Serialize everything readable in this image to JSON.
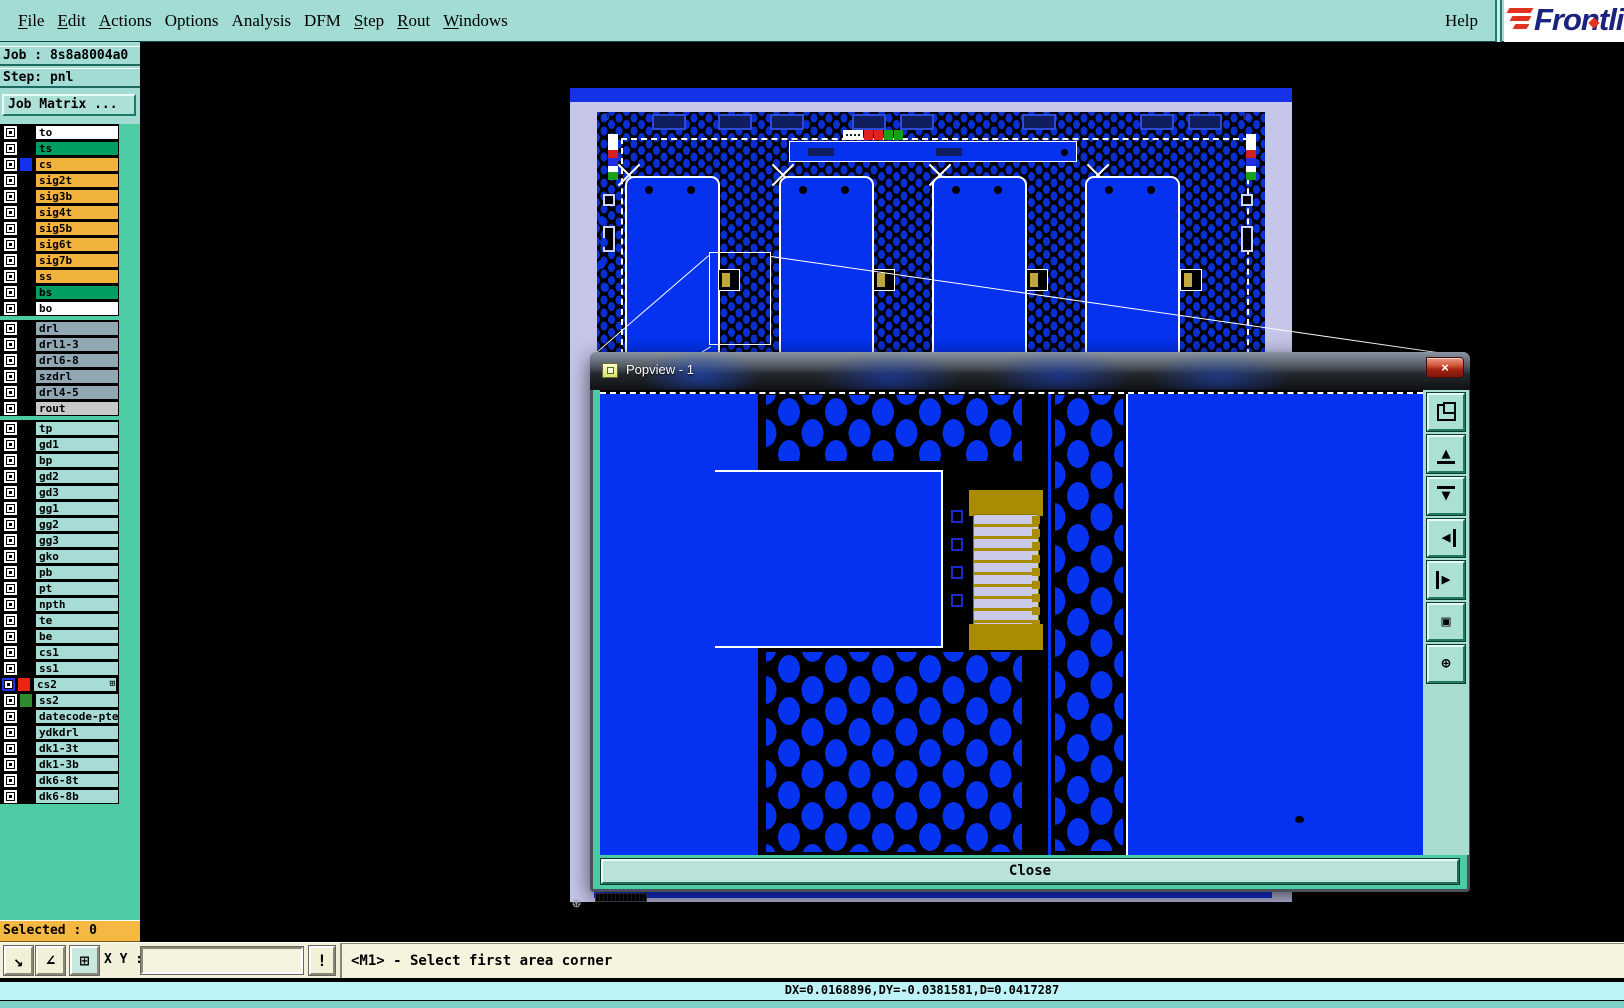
{
  "menu": {
    "items": [
      {
        "label": "File",
        "underline": 0
      },
      {
        "label": "Edit",
        "underline": 0
      },
      {
        "label": "Actions",
        "underline": 0
      },
      {
        "label": "Options",
        "underline": -1
      },
      {
        "label": "Analysis",
        "underline": -1
      },
      {
        "label": "DFM",
        "underline": -1
      },
      {
        "label": "Step",
        "underline": 0
      },
      {
        "label": "Rout",
        "underline": 0
      },
      {
        "label": "Windows",
        "underline": 0
      }
    ],
    "help_label": "Help"
  },
  "logo": {
    "text": "Frontli",
    "brand_color": "#1A2380",
    "stripe_color": "#E23222"
  },
  "sidebar": {
    "job_label": "Job : 8s8a8004a0",
    "step_label": "Step: pnl",
    "job_matrix_button": "Job Matrix ...",
    "selected_label": "Selected : 0",
    "layer_groups": [
      {
        "rows": [
          {
            "name": "to",
            "bg": "#FFFFFF"
          },
          {
            "name": "ts",
            "bg": "#009E60"
          },
          {
            "name": "cs",
            "bg": "#F2B33D",
            "swatch": "#1133EE"
          },
          {
            "name": "sig2t",
            "bg": "#F2B33D"
          },
          {
            "name": "sig3b",
            "bg": "#F2B33D"
          },
          {
            "name": "sig4t",
            "bg": "#F2B33D"
          },
          {
            "name": "sig5b",
            "bg": "#F2B33D"
          },
          {
            "name": "sig6t",
            "bg": "#F2B33D"
          },
          {
            "name": "sig7b",
            "bg": "#F2B33D"
          },
          {
            "name": "ss",
            "bg": "#F2B33D"
          },
          {
            "name": "bs",
            "bg": "#009E60"
          },
          {
            "name": "bo",
            "bg": "#FFFFFF"
          }
        ]
      },
      {
        "rows": [
          {
            "name": "drl",
            "bg": "#91A7B3"
          },
          {
            "name": "drl1-3",
            "bg": "#91A7B3"
          },
          {
            "name": "drl6-8",
            "bg": "#91A7B3"
          },
          {
            "name": "szdrl",
            "bg": "#91A7B3"
          },
          {
            "name": "drl4-5",
            "bg": "#91A7B3"
          },
          {
            "name": "rout",
            "bg": "#C9C9C9"
          }
        ]
      },
      {
        "rows": [
          {
            "name": "tp",
            "bg": "#A6DCD5"
          },
          {
            "name": "gd1",
            "bg": "#A6DCD5"
          },
          {
            "name": "bp",
            "bg": "#A6DCD5"
          },
          {
            "name": "gd2",
            "bg": "#A6DCD5"
          },
          {
            "name": "gd3",
            "bg": "#A6DCD5"
          },
          {
            "name": "gg1",
            "bg": "#A6DCD5"
          },
          {
            "name": "gg2",
            "bg": "#A6DCD5"
          },
          {
            "name": "gg3",
            "bg": "#A6DCD5"
          },
          {
            "name": "gko",
            "bg": "#A6DCD5"
          },
          {
            "name": "pb",
            "bg": "#A6DCD5"
          },
          {
            "name": "pt",
            "bg": "#A6DCD5"
          },
          {
            "name": "npth",
            "bg": "#A6DCD5"
          },
          {
            "name": "te",
            "bg": "#A6DCD5"
          },
          {
            "name": "be",
            "bg": "#A6DCD5"
          },
          {
            "name": "cs1",
            "bg": "#A6DCD5"
          },
          {
            "name": "ss1",
            "bg": "#A6DCD5"
          },
          {
            "name": "cs2",
            "bg": "#A6DCD5",
            "swatch": "#EE2211",
            "active": true,
            "grid": "⊞"
          },
          {
            "name": "ss2",
            "bg": "#A6DCD5",
            "swatch": "#2E8B2E"
          },
          {
            "name": "datecode-pte",
            "bg": "#A6DCD5"
          },
          {
            "name": "ydkdrl",
            "bg": "#A6DCD5"
          },
          {
            "name": "dk1-3t",
            "bg": "#A6DCD5"
          },
          {
            "name": "dk1-3b",
            "bg": "#A6DCD5"
          },
          {
            "name": "dk6-8t",
            "bg": "#A6DCD5"
          },
          {
            "name": "dk6-8b",
            "bg": "#A6DCD5"
          }
        ]
      }
    ]
  },
  "bottom_bar": {
    "tools": [
      {
        "icon": "zoom-area-icon",
        "glyph": "↘"
      },
      {
        "icon": "measure-angle-icon",
        "glyph": "∠"
      },
      {
        "icon": "tile-windows-icon",
        "glyph": "⊞"
      }
    ],
    "xy_label": "X Y :",
    "input_value": "",
    "warn_button_glyph": "!",
    "message": "<M1> - Select first area corner"
  },
  "status_bar": {
    "text": "DX=0.0168896,DY=-0.0381581,D=0.0417287"
  },
  "popview": {
    "title": "Popview - 1",
    "close_x_glyph": "×",
    "close_button": "Close",
    "toolbar": [
      {
        "icon": "duplicate-view-icon",
        "glyph": ""
      },
      {
        "icon": "pan-up-icon",
        "glyph": "▲"
      },
      {
        "icon": "pan-down-icon",
        "glyph": "▼"
      },
      {
        "icon": "pan-left-icon",
        "glyph": "◀"
      },
      {
        "icon": "pan-right-icon",
        "glyph": "▶"
      },
      {
        "icon": "zoom-fit-icon",
        "glyph": "▣"
      },
      {
        "icon": "pan-center-icon",
        "glyph": "⊕"
      }
    ]
  },
  "colors": {
    "menubar_bg": "#A3DBD5",
    "sidebar_bg": "#4DCBA4",
    "orange": "#F2B33D",
    "selected_bg": "#F5B843",
    "board_blue": "#0432EE",
    "panel_lavender": "#C6C6EA",
    "gold": "#A98C00",
    "status_cyan": "#BDF3F7",
    "cream": "#F2F0D8"
  }
}
